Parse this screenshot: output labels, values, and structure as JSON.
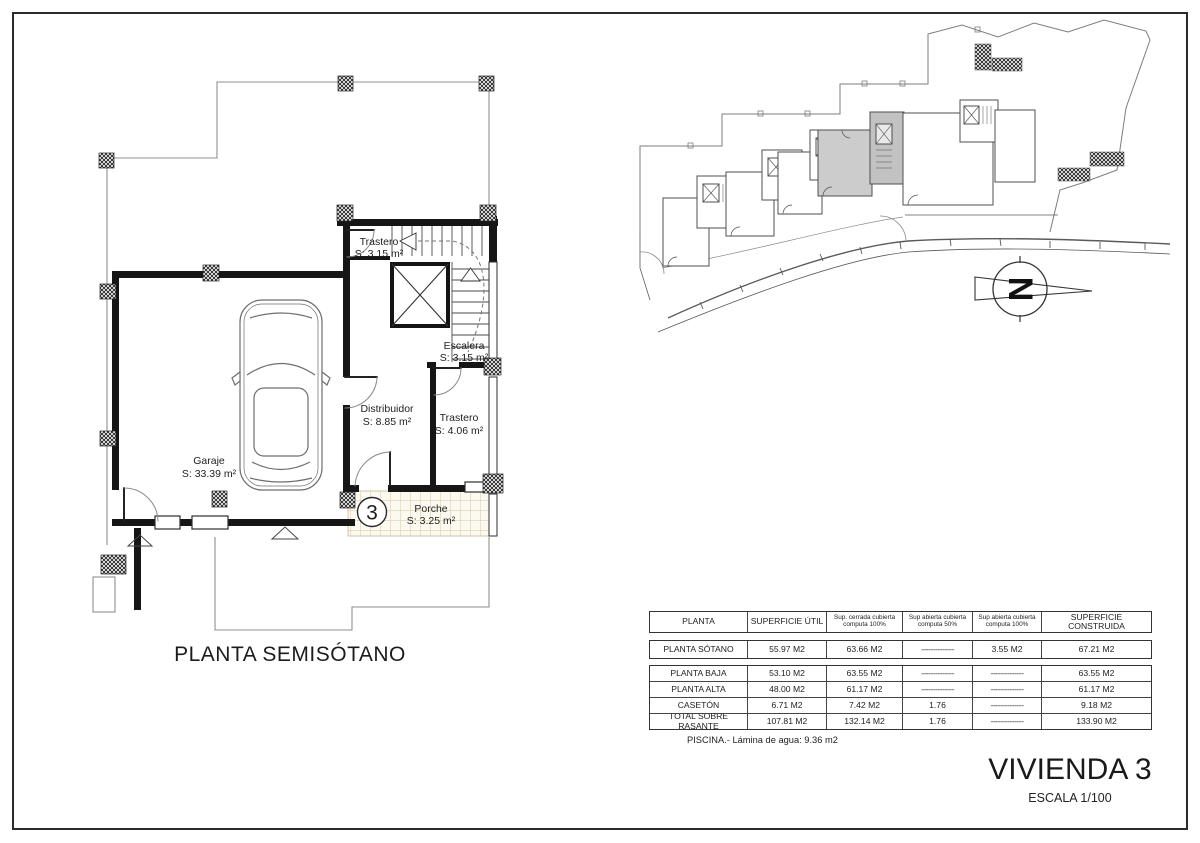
{
  "sheet": {
    "plan_title": "PLANTA SEMISÓTANO",
    "project_title": "VIVIENDA 3",
    "scale": "ESCALA 1/100"
  },
  "floor_plan": {
    "unit_number": "3",
    "rooms": {
      "trastero_alto": {
        "name": "Trastero",
        "area": "S: 3.15 m²"
      },
      "escalera": {
        "name": "Escalera",
        "area": "S: 3.15 m²"
      },
      "distribuidor": {
        "name": "Distribuidor",
        "area": "S: 8.85 m²"
      },
      "trastero_bajo": {
        "name": "Trastero",
        "area": "S: 4.06 m²"
      },
      "garaje": {
        "name": "Garaje",
        "area": "S: 33.39 m²"
      },
      "porche": {
        "name": "Porche",
        "area": "S: 3.25 m²"
      }
    }
  },
  "site_plan": {
    "north_label": "N",
    "highlight_color": "#cccccc"
  },
  "table": {
    "headers": [
      "PLANTA",
      "SUPERFICIE ÚTIL",
      "Sup. cerrada cubierta computa 100%",
      "Sup abierta cubierta computa 50%",
      "Sup abierta cubierta computa 100%",
      "SUPERFICIE CONSTRUIDA"
    ],
    "rows": [
      [
        "PLANTA SÓTANO",
        "55.97 M2",
        "63.66 M2",
        "--------------",
        "3.55 M2",
        "67.21 M2"
      ],
      [
        "PLANTA BAJA",
        "53.10 M2",
        "63.55 M2",
        "--------------",
        "--------------",
        "63.55 M2"
      ],
      [
        "PLANTA ALTA",
        "48.00 M2",
        "61.17 M2",
        "--------------",
        "--------------",
        "61.17 M2"
      ],
      [
        "CASETÓN",
        "6.71 M2",
        "7.42 M2",
        "1.76",
        "--------------",
        "9.18 M2"
      ],
      [
        "TOTAL SOBRE RASANTE",
        "107.81 M2",
        "132.14 M2",
        "1.76",
        "--------------",
        "133.90 M2"
      ]
    ],
    "footnote": "PISCINA.- Lámina de agua: 9.36 m2"
  }
}
